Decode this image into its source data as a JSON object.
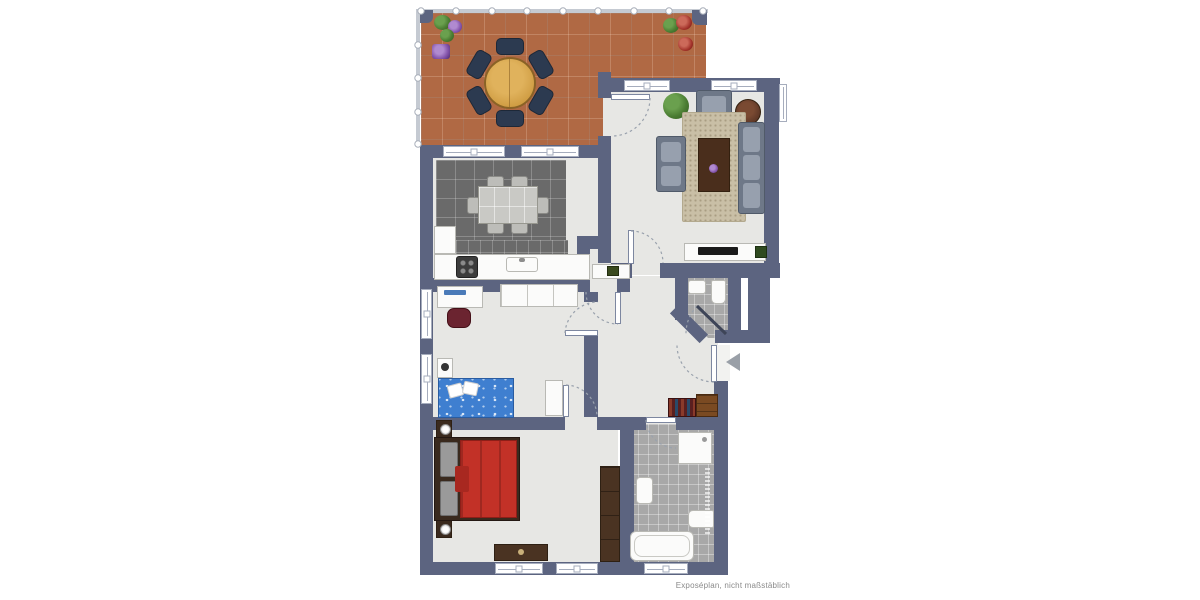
{
  "document": {
    "footer_note": "Exposéplan, nicht maßstäblich"
  },
  "colors": {
    "wall": "#5c6480",
    "floor": "#e7e7e4",
    "terrace": "#b06944",
    "dining_tile": "#6a6a6a",
    "bath_tile": "#a8a8a8",
    "rug": "#c9bfa6",
    "upholstery": "#6e7888",
    "cushion": "#97a0ae",
    "wood": "#cf9c42",
    "dark_wood": "#4a3322",
    "red_bed": "#c23127",
    "blue_bed": "#3f7fd0",
    "railing": "#c5cad2",
    "arrow": "#9aa0a8",
    "plant": "#4a7c32",
    "accent_purple": "#8050a8",
    "accent_red": "#a03028",
    "tv": "#1a1a1a"
  },
  "rooms": {
    "terrace": [
      "round-dining-table",
      "six-chairs",
      "planters"
    ],
    "living_room": [
      "sofa",
      "two-armchairs",
      "rug",
      "coffee-table",
      "side-table",
      "tv-sideboard",
      "plant"
    ],
    "kitchen_dining": [
      "dining-table",
      "six-chairs",
      "kitchen-counter",
      "stove",
      "sink"
    ],
    "childrens_room": [
      "desk",
      "desk-chair",
      "wardrobe",
      "single-bed",
      "nightstand"
    ],
    "bedroom": [
      "double-bed",
      "two-nightstands",
      "wardrobe",
      "dresser"
    ],
    "bathroom": [
      "shower",
      "washbasin",
      "toilet",
      "bathtub"
    ],
    "guest_wc": [
      "washbasin",
      "toilet"
    ],
    "hallway": [
      "sideboard",
      "bookshelf",
      "dresser",
      "entrance-arrow"
    ]
  }
}
